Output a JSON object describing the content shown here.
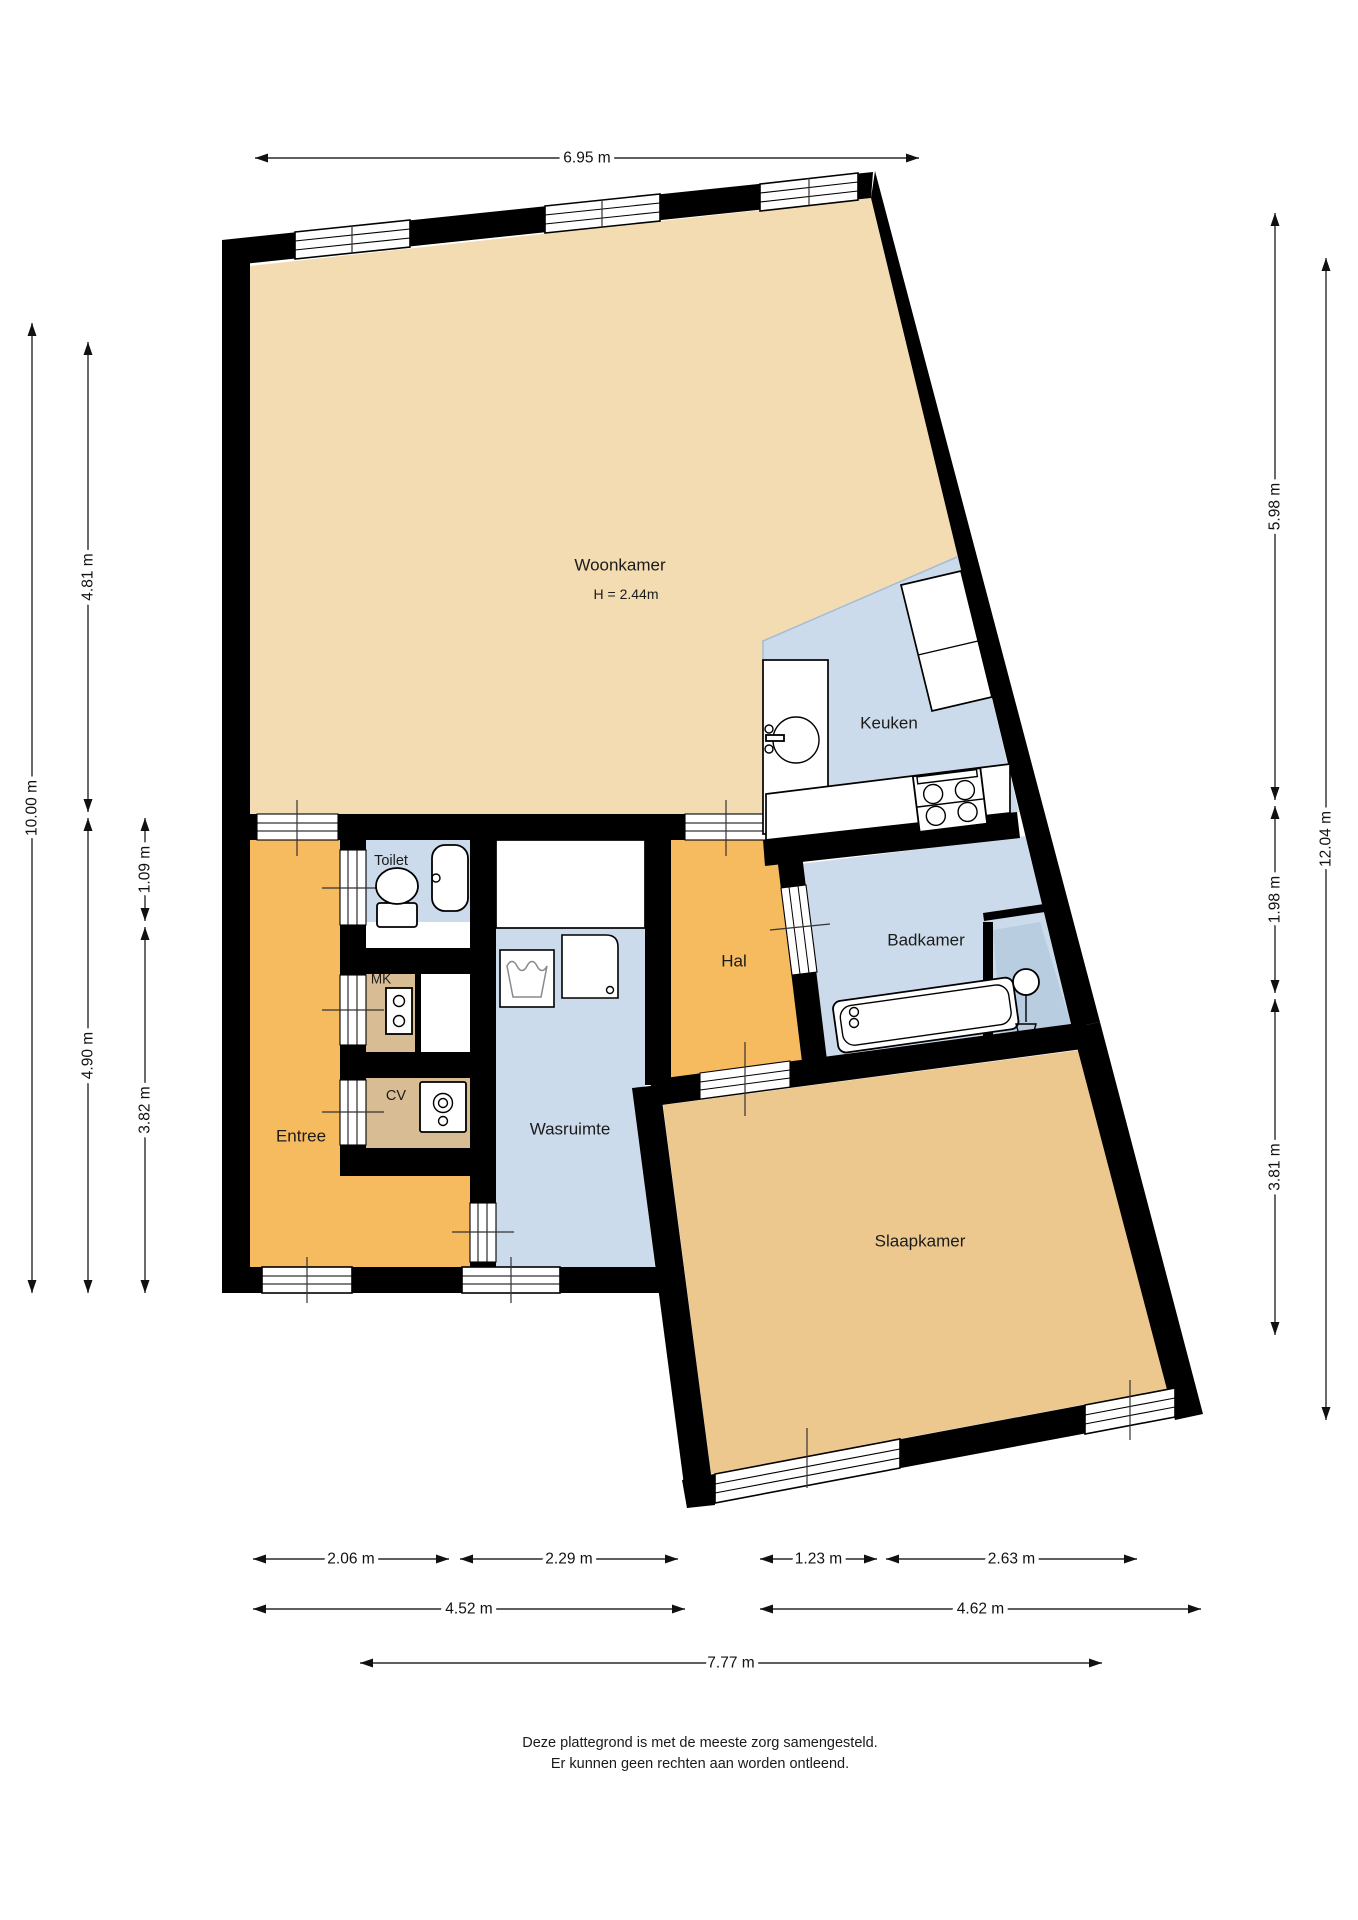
{
  "floorplan": {
    "rooms": {
      "woonkamer": {
        "label": "Woonkamer",
        "note": "H = 2.44m"
      },
      "keuken": {
        "label": "Keuken"
      },
      "toilet": {
        "label": "Toilet"
      },
      "mk": {
        "label": "MK"
      },
      "cv": {
        "label": "CV"
      },
      "entree": {
        "label": "Entree"
      },
      "wasruimte": {
        "label": "Wasruimte"
      },
      "hal": {
        "label": "Hal"
      },
      "badkamer": {
        "label": "Badkamer"
      },
      "slaapkamer": {
        "label": "Slaapkamer"
      }
    },
    "colors": {
      "wall": "#000000",
      "living": "#F3DCB2",
      "bedroom": "#ECC88F",
      "utility": "#D8BD94",
      "hallway": "#F6BA5F",
      "wet": "#CBDBEB",
      "shower": "#B9CDE0"
    },
    "dimensions": [
      {
        "id": "top-width",
        "label": "6.95 m",
        "o": "h",
        "x1": 255,
        "x2": 919,
        "y": 158
      },
      {
        "id": "left-total",
        "label": "10.00 m",
        "o": "v",
        "x": 32,
        "y1": 323,
        "y2": 1293
      },
      {
        "id": "left-upper",
        "label": "4.81 m",
        "o": "v",
        "x": 88,
        "y1": 342,
        "y2": 812
      },
      {
        "id": "left-lower",
        "label": "4.90 m",
        "o": "v",
        "x": 88,
        "y1": 818,
        "y2": 1293
      },
      {
        "id": "left-toilet-depth",
        "label": "1.09 m",
        "o": "v",
        "x": 145,
        "y1": 818,
        "y2": 921
      },
      {
        "id": "left-lower-inner",
        "label": "3.82 m",
        "o": "v",
        "x": 145,
        "y1": 927,
        "y2": 1293
      },
      {
        "id": "right-upper",
        "label": "5.98 m",
        "o": "v",
        "x": 1275,
        "y1": 213,
        "y2": 800
      },
      {
        "id": "right-middle",
        "label": "1.98 m",
        "o": "v",
        "x": 1275,
        "y1": 806,
        "y2": 993
      },
      {
        "id": "right-lower",
        "label": "3.81 m",
        "o": "v",
        "x": 1275,
        "y1": 999,
        "y2": 1335
      },
      {
        "id": "right-total",
        "label": "12.04 m",
        "o": "v",
        "x": 1326,
        "y1": 258,
        "y2": 1420
      },
      {
        "id": "bottom-entree",
        "label": "2.06 m",
        "o": "h",
        "x1": 253,
        "x2": 449,
        "y": 1559
      },
      {
        "id": "bottom-wasruimte",
        "label": "2.29 m",
        "o": "h",
        "x1": 460,
        "x2": 678,
        "y": 1559
      },
      {
        "id": "bottom-hal",
        "label": "1.23 m",
        "o": "h",
        "x1": 760,
        "x2": 877,
        "y": 1559
      },
      {
        "id": "bottom-slaapkamer",
        "label": "2.63 m",
        "o": "h",
        "x1": 886,
        "x2": 1137,
        "y": 1559
      },
      {
        "id": "bottom-left-half",
        "label": "4.52 m",
        "o": "h",
        "x1": 253,
        "x2": 685,
        "y": 1609
      },
      {
        "id": "bottom-right-half",
        "label": "4.62 m",
        "o": "h",
        "x1": 760,
        "x2": 1201,
        "y": 1609
      },
      {
        "id": "bottom-total",
        "label": "7.77 m",
        "o": "h",
        "x1": 360,
        "x2": 1102,
        "y": 1663
      }
    ],
    "disclaimer": {
      "line1": "Deze plattegrond is met de meeste zorg samengesteld.",
      "line2": "Er kunnen geen rechten aan worden ontleend."
    }
  }
}
